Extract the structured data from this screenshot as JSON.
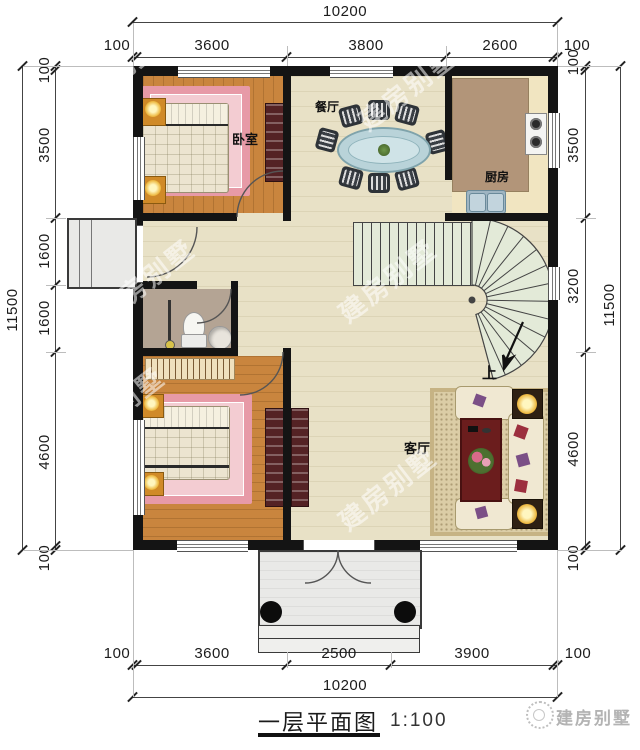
{
  "title": {
    "text": "一层平面图",
    "scale": "1:100"
  },
  "watermark": {
    "text": "建房别墅"
  },
  "rooms": {
    "bedroom": "卧室",
    "dining": "餐厅",
    "kitchen": "厨房",
    "living": "客厅",
    "stairs_up": "上"
  },
  "dims": {
    "top": {
      "total": "10200",
      "segments": [
        "100",
        "3600",
        "3800",
        "2600",
        "100"
      ]
    },
    "bottom": {
      "total": "10200",
      "segments": [
        "100",
        "3600",
        "2500",
        "3900",
        "100"
      ]
    },
    "left": {
      "total": "11500",
      "segments": [
        "100",
        "3500",
        "1600",
        "1600",
        "4600",
        "100"
      ]
    },
    "right": {
      "total": "11500",
      "segments": [
        "100",
        "3500",
        "3200",
        "4600",
        "100"
      ]
    }
  },
  "colors": {
    "wall": "#141414",
    "bedroom_floor": "#c9853e",
    "hall_floor": "#e8e1c6",
    "kitchen_counter": "#b29579",
    "bathroom_floor": "#b4a494",
    "stair_tread": "#e3ead8",
    "rug_pink": "#e79aa7",
    "sofa_cream": "#f0e8d2",
    "table_blue": "#b9d3d9",
    "coffee_table_red": "#6b1d1d"
  }
}
